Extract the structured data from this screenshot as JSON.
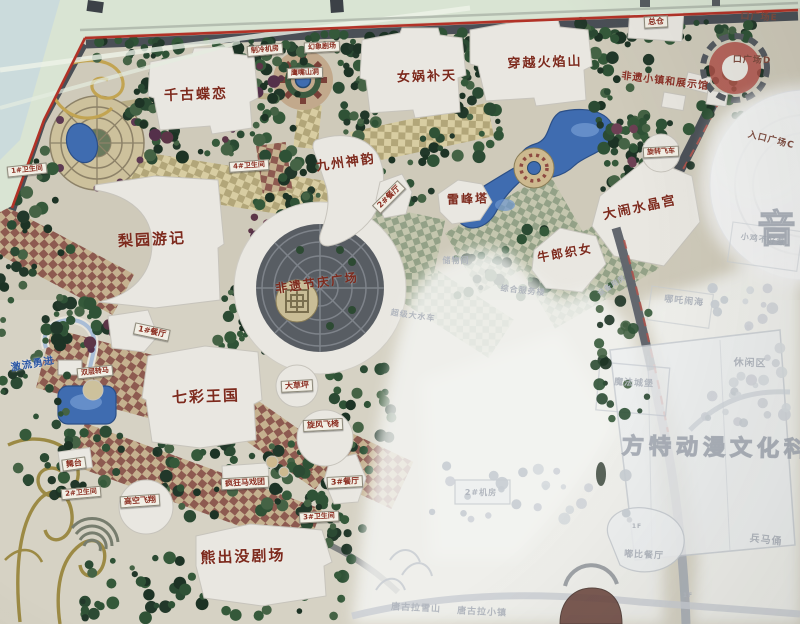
{
  "meta": {
    "description": "Photograph of a Fantawild theme-park site map board; right half washed out by glare"
  },
  "colors": {
    "attraction_text": "#7d2a1d",
    "sign_text": "#8b2f22",
    "sign_bg": "#f2efe5",
    "faded_text": "#b2b7bf",
    "blue_text": "#2b57a5",
    "water": "#3f6cb0",
    "map_red_border": "#b23227",
    "road": "#4a4f56",
    "vegetation": "#2b4a33",
    "building": "#e9e7e1"
  },
  "labels": {
    "attractions": [
      {
        "id": "qiangu-dielian",
        "text": "千古蝶恋",
        "x": 196,
        "y": 95,
        "size": 14,
        "rot": -2
      },
      {
        "id": "nuwa-butian",
        "text": "女娲补天",
        "x": 427,
        "y": 77,
        "size": 13,
        "rot": -2
      },
      {
        "id": "chuanyue-huoyanshan",
        "text": "穿越火焰山",
        "x": 545,
        "y": 63,
        "size": 13,
        "rot": -2
      },
      {
        "id": "jiuzhou-shenyun",
        "text": "九州神韵",
        "x": 346,
        "y": 163,
        "size": 13,
        "rot": -8
      },
      {
        "id": "leifengta",
        "text": "雷峰塔",
        "x": 468,
        "y": 199,
        "size": 12,
        "rot": -2
      },
      {
        "id": "danao-shuijinggong",
        "text": "大闹水晶宫",
        "x": 640,
        "y": 208,
        "size": 13,
        "rot": -12
      },
      {
        "id": "niulang-zhinv",
        "text": "牛郎织女",
        "x": 565,
        "y": 253,
        "size": 12,
        "rot": -10
      },
      {
        "id": "liyuan-youji",
        "text": "梨园游记",
        "x": 152,
        "y": 240,
        "size": 15,
        "rot": -3
      },
      {
        "id": "feiyi-jieqing-guangchang",
        "text": "非遗节庆广场",
        "x": 317,
        "y": 283,
        "size": 12,
        "rot": -8
      },
      {
        "id": "qicai-wangguo",
        "text": "七彩王国",
        "x": 206,
        "y": 397,
        "size": 15,
        "rot": -2
      },
      {
        "id": "xiongchumo-juchang",
        "text": "熊出没剧场",
        "x": 243,
        "y": 557,
        "size": 15,
        "rot": -2
      }
    ],
    "signs": [
      {
        "id": "zongcang",
        "text": "总仓",
        "x": 656,
        "y": 22,
        "size": 8,
        "rot": -3
      },
      {
        "id": "zhileng-jifang",
        "text": "制冷机房",
        "x": 265,
        "y": 50,
        "size": 7,
        "rot": -5
      },
      {
        "id": "huanxiang-juchang",
        "text": "幻象剧场",
        "x": 322,
        "y": 47,
        "size": 7,
        "rot": -3
      },
      {
        "id": "yingzui-shandong",
        "text": "鹰嘴山洞",
        "x": 305,
        "y": 73,
        "size": 7,
        "rot": -2
      },
      {
        "id": "weishengjian-1",
        "text": "1#卫生间",
        "x": 27,
        "y": 170,
        "size": 7,
        "rot": -6
      },
      {
        "id": "weishengjian-4",
        "text": "4#卫生间",
        "x": 249,
        "y": 166,
        "size": 7,
        "rot": -4
      },
      {
        "id": "canting-2",
        "text": "2#餐厅",
        "x": 389,
        "y": 197,
        "size": 8,
        "rot": -45
      },
      {
        "id": "canting-1",
        "text": "1#餐厅",
        "x": 152,
        "y": 332,
        "size": 8,
        "rot": 12
      },
      {
        "id": "shuangceng-zhuanma",
        "text": "双层转马",
        "x": 95,
        "y": 372,
        "size": 7,
        "rot": -6
      },
      {
        "id": "wutai",
        "text": "舞台",
        "x": 74,
        "y": 464,
        "size": 8,
        "rot": -8
      },
      {
        "id": "weishengjian-2",
        "text": "2#卫生间",
        "x": 81,
        "y": 493,
        "size": 7,
        "rot": -5
      },
      {
        "id": "gaokong-feixiang",
        "text": "高空飞翔",
        "x": 140,
        "y": 501,
        "size": 8,
        "rot": -4
      },
      {
        "id": "fengkuang-maxituan",
        "text": "疯狂马戏团",
        "x": 245,
        "y": 483,
        "size": 8,
        "rot": -3
      },
      {
        "id": "xuanfeng-feiyi",
        "text": "旋风飞椅",
        "x": 323,
        "y": 425,
        "size": 8,
        "rot": -3
      },
      {
        "id": "canting-3",
        "text": "3#餐厅",
        "x": 345,
        "y": 482,
        "size": 8,
        "rot": -3
      },
      {
        "id": "weishengjian-3",
        "text": "3#卫生间",
        "x": 319,
        "y": 517,
        "size": 7,
        "rot": -3
      },
      {
        "id": "dacaoping",
        "text": "大草坪",
        "x": 297,
        "y": 386,
        "size": 8,
        "rot": -3
      },
      {
        "id": "xuanzhuan-feiche",
        "text": "旋转飞车",
        "x": 661,
        "y": 152,
        "size": 7,
        "rot": -3
      }
    ],
    "plains": [
      {
        "id": "feiyi-xiaozhen",
        "text": "非遗小镇和展示馆",
        "x": 665,
        "y": 82,
        "size": 10,
        "rot": 7
      }
    ],
    "entrances": [
      {
        "id": "rukou-e",
        "text": "口广场E",
        "x": 759,
        "y": 18,
        "size": 9,
        "rot": 3
      },
      {
        "id": "rukou-d",
        "text": "口广场D",
        "x": 752,
        "y": 61,
        "size": 9,
        "rot": 2
      },
      {
        "id": "rukou-c",
        "text": "入口广场C",
        "x": 771,
        "y": 141,
        "size": 9,
        "rot": 14
      }
    ],
    "blue": [
      {
        "id": "jiliu-yongjin",
        "text": "激流勇进",
        "x": 33,
        "y": 365,
        "size": 10,
        "rot": -10
      }
    ],
    "faded": [
      {
        "id": "chuwujian",
        "text": "储物间",
        "x": 456,
        "y": 261,
        "size": 8,
        "rot": 0
      },
      {
        "id": "zonghe-fuwulou",
        "text": "综合服务楼",
        "x": 523,
        "y": 291,
        "size": 8,
        "rot": 6
      },
      {
        "id": "shebei-yongfang",
        "text": "设备用房",
        "x": 612,
        "y": 286,
        "size": 7,
        "rot": -33
      },
      {
        "id": "chaoji-dashuiche",
        "text": "超级大水车",
        "x": 413,
        "y": 316,
        "size": 8,
        "rot": 8
      },
      {
        "id": "nezha-naohai",
        "text": "哪吒闹海",
        "x": 684,
        "y": 302,
        "size": 9,
        "rot": 6
      },
      {
        "id": "xiaoji-buhaore",
        "text": "小鸡不好惹",
        "x": 763,
        "y": 240,
        "size": 8,
        "rot": 8
      },
      {
        "id": "xiuxianqu",
        "text": "休闲区",
        "x": 750,
        "y": 364,
        "size": 10,
        "rot": 2
      },
      {
        "id": "mofa-chengbao",
        "text": "魔法城堡",
        "x": 634,
        "y": 384,
        "size": 9,
        "rot": 3
      },
      {
        "id": "bingmayong",
        "text": "兵马俑",
        "x": 766,
        "y": 541,
        "size": 10,
        "rot": 6
      },
      {
        "id": "dubi-canting",
        "text": "嘟比餐厅",
        "x": 644,
        "y": 556,
        "size": 9,
        "rot": 3
      },
      {
        "id": "jifang-2",
        "text": "2#机房",
        "x": 481,
        "y": 493,
        "size": 8,
        "rot": 0
      },
      {
        "id": "tanggula-xueshan",
        "text": "唐古拉雪山",
        "x": 416,
        "y": 609,
        "size": 9,
        "rot": 3
      },
      {
        "id": "tanggula-xiaozhen",
        "text": "唐古拉小镇",
        "x": 482,
        "y": 613,
        "size": 9,
        "rot": 3
      },
      {
        "id": "floor-1f-a",
        "text": "1F",
        "x": 637,
        "y": 527,
        "size": 6,
        "rot": 0
      },
      {
        "id": "floor-1f-b",
        "text": "1F",
        "x": 688,
        "y": 596,
        "size": 6,
        "rot": 0
      }
    ],
    "watermarks": [
      {
        "id": "wm-fangte",
        "text": "方特动漫文化科技",
        "x": 730,
        "y": 449,
        "size": 22,
        "rot": 1
      },
      {
        "id": "wm-yin",
        "text": "音",
        "x": 779,
        "y": 229,
        "size": 38,
        "rot": 0
      }
    ]
  }
}
